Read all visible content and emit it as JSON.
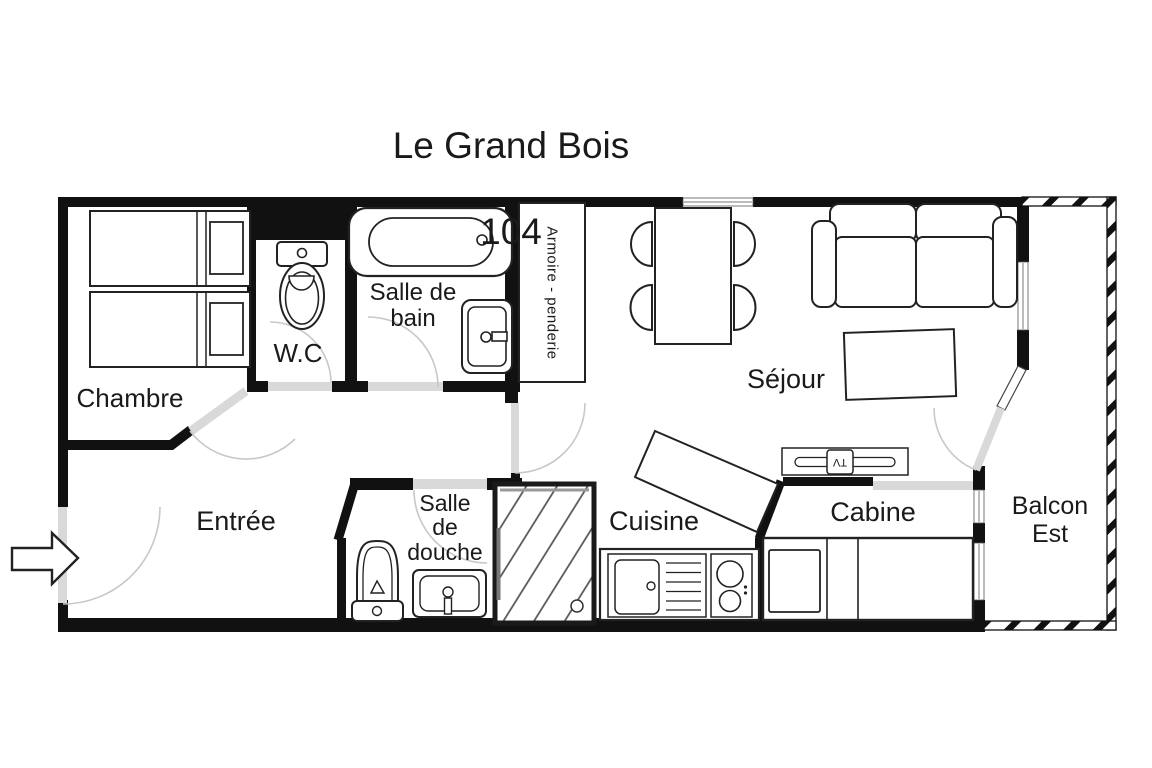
{
  "title": {
    "line1": "Le Grand Bois",
    "line2": "104"
  },
  "rooms": {
    "chambre": {
      "label": "Chambre"
    },
    "wc": {
      "label": "W.C"
    },
    "salle_de_bain": {
      "label": "Salle de\nbain"
    },
    "armoire": {
      "label": "Armoire - penderie"
    },
    "sejour": {
      "label": "Séjour"
    },
    "entree": {
      "label": "Entrée"
    },
    "salle_de_douche": {
      "label": "Salle\nde\ndouche"
    },
    "cuisine": {
      "label": "Cuisine"
    },
    "cabine": {
      "label": "Cabine"
    },
    "balcon": {
      "label": "Balcon\nEst"
    }
  },
  "furniture": {
    "tv": {
      "label": "TV"
    }
  },
  "colors": {
    "background": "#ffffff",
    "wall": "#111111",
    "furniture_outline": "#222222",
    "door_leaf": "#d9d9d9",
    "door_arc": "#c8c8c8",
    "text": "#1a1a1a"
  }
}
